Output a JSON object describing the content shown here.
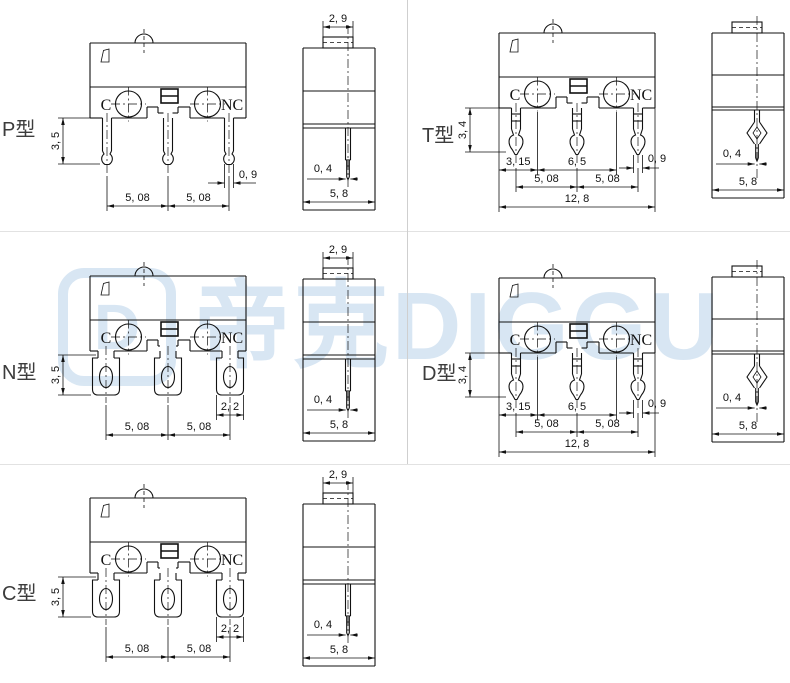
{
  "canvas": {
    "background": "#ffffff",
    "divider_color_horizontal": "#e2e2e2",
    "divider_color_vertical": "#cfcfcf"
  },
  "watermark": {
    "logo_letter": "D",
    "text": "帝克DIGGU",
    "color": "#b9d3ea"
  },
  "panels": [
    {
      "id": "P",
      "label": "P型",
      "front": {
        "style": "pin",
        "terminal_left": "C",
        "terminal_right": "NC",
        "dims": {
          "height": "3, 5",
          "pitch_left": "5, 08",
          "pitch_right": "5, 08",
          "pin_width": "0, 9"
        }
      },
      "side": {
        "style": "straight",
        "dims": {
          "button_width": "2, 9",
          "pin_thickness": "0, 4",
          "body_width": "5, 8"
        }
      }
    },
    {
      "id": "T",
      "label": "T型",
      "front": {
        "style": "barb",
        "terminal_left": "C",
        "terminal_right": "NC",
        "dims": {
          "height": "3, 4",
          "edge_to_c": "3, 15",
          "c_to_nc": "6, 5",
          "pin_width": "0, 9",
          "pitch_left": "5, 08",
          "pitch_right": "5, 08",
          "total_width": "12, 8"
        }
      },
      "side": {
        "style": "kink",
        "dims": {
          "pin_thickness": "0, 4",
          "body_width": "5, 8"
        }
      }
    },
    {
      "id": "N",
      "label": "N型",
      "front": {
        "style": "lug",
        "terminal_left": "C",
        "terminal_right": "NC",
        "dims": {
          "height": "3, 5",
          "lug_width": "2, 2",
          "pitch_left": "5, 08",
          "pitch_right": "5, 08"
        }
      },
      "side": {
        "style": "straight",
        "dims": {
          "button_width": "2, 9",
          "pin_thickness": "0, 4",
          "body_width": "5, 8"
        }
      }
    },
    {
      "id": "D",
      "label": "D型",
      "front": {
        "style": "barb",
        "terminal_left": "C",
        "terminal_right": "NC",
        "dims": {
          "height": "3, 4",
          "edge_to_c": "3, 15",
          "c_to_nc": "6, 5",
          "pin_width": "0, 9",
          "pitch_left": "5, 08",
          "pitch_right": "5, 08",
          "total_width": "12, 8"
        }
      },
      "side": {
        "style": "kink",
        "dims": {
          "pin_thickness": "0, 4",
          "body_width": "5, 8"
        }
      }
    },
    {
      "id": "C",
      "label": "C型",
      "front": {
        "style": "lug",
        "terminal_left": "C",
        "terminal_right": "NC",
        "dims": {
          "height": "3, 5",
          "lug_width": "2, 2",
          "pitch_left": "5, 08",
          "pitch_right": "5, 08"
        }
      },
      "side": {
        "style": "straight",
        "dims": {
          "button_width": "2, 9",
          "pin_thickness": "0, 4",
          "body_width": "5, 8"
        }
      }
    }
  ]
}
